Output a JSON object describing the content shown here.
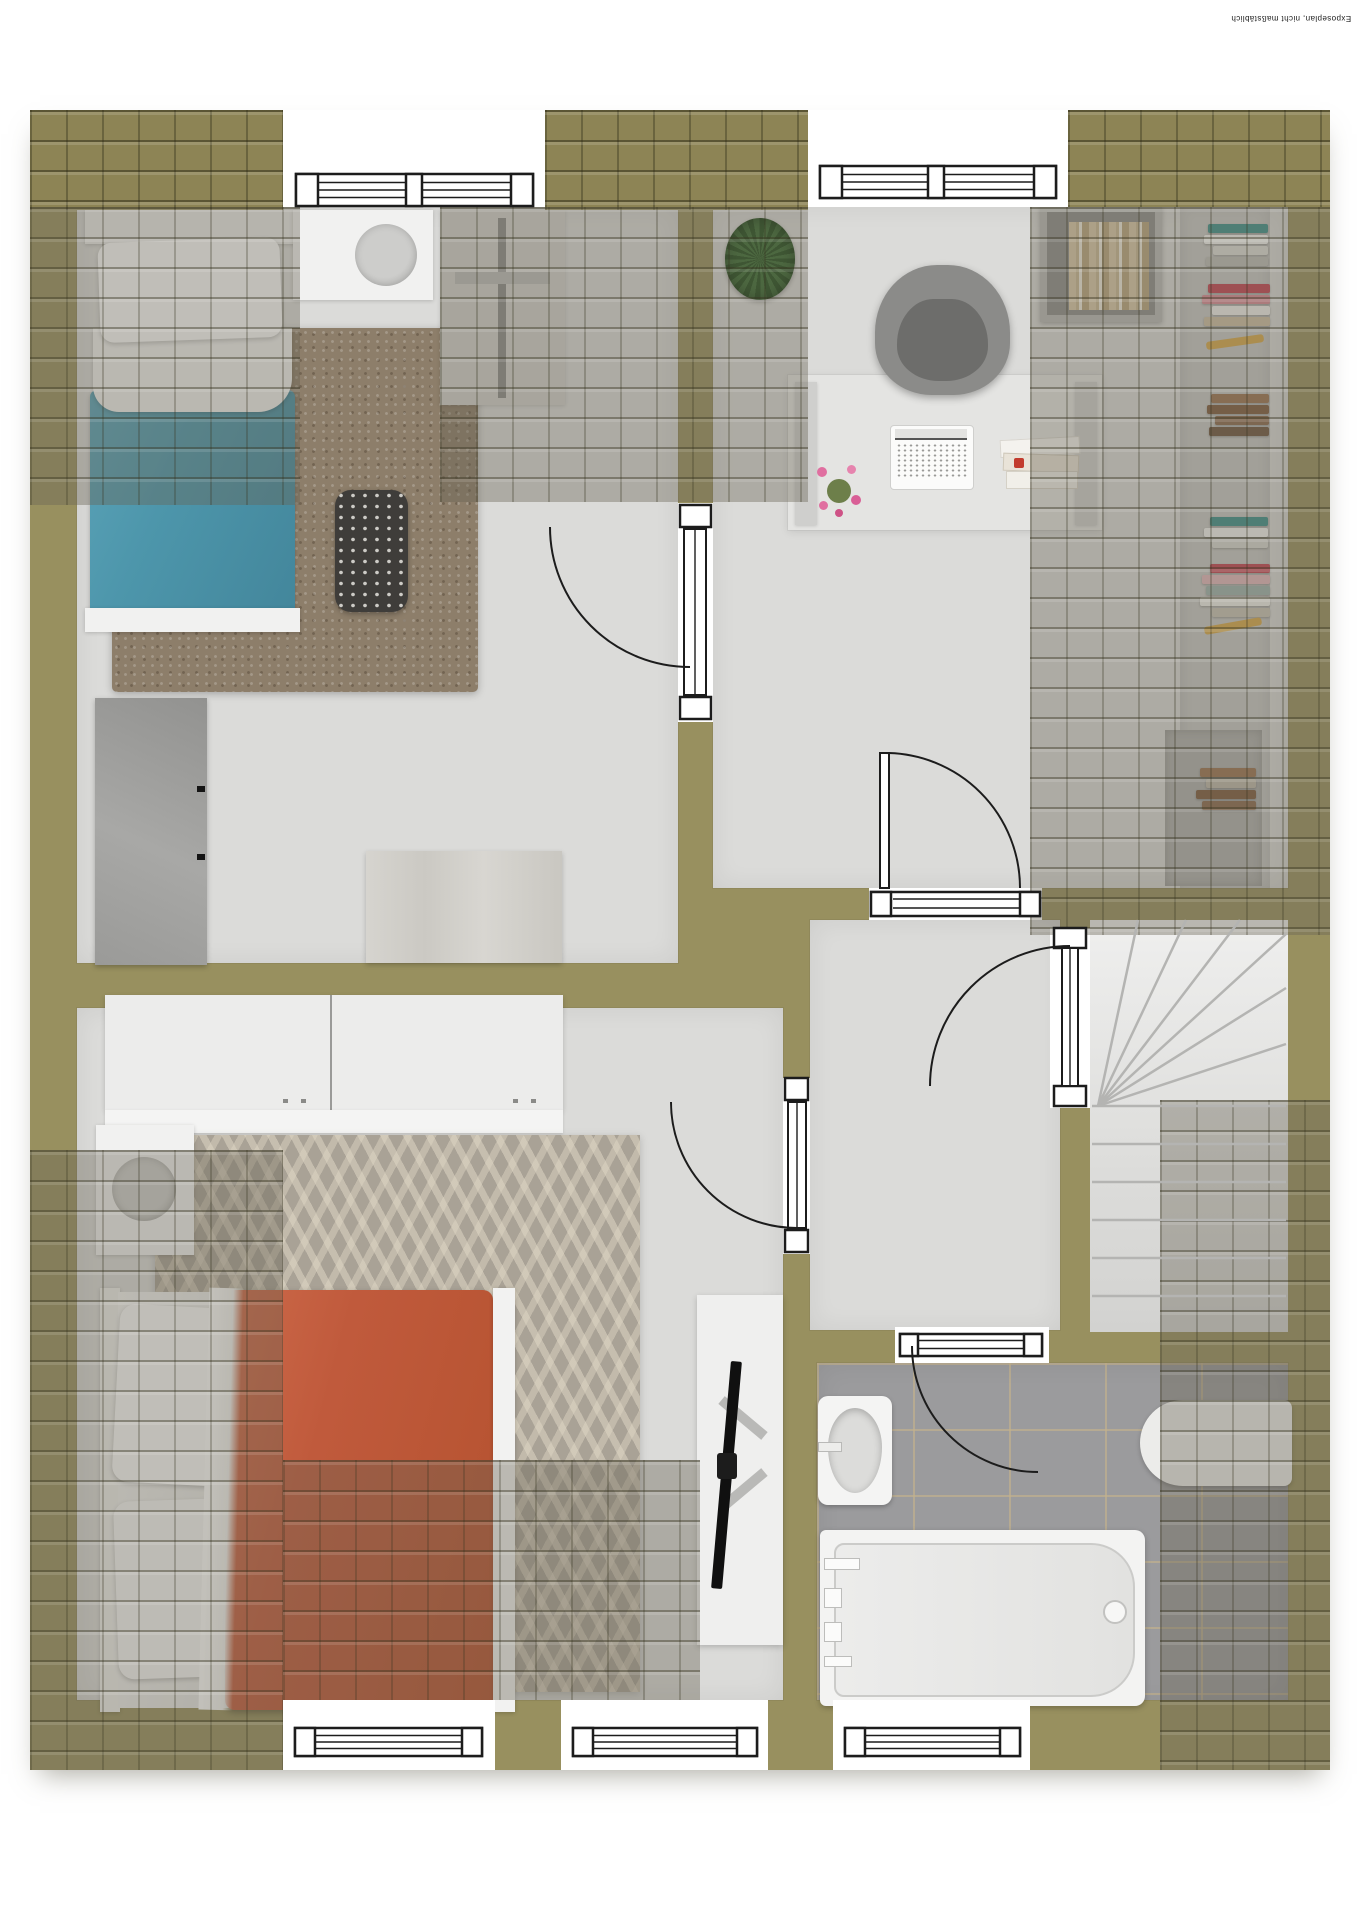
{
  "watermark": {
    "text": "Exposeplan, nicht maßstäblich"
  },
  "plan": {
    "type": "3d-floor-plan-top-view",
    "wall_color": "#98905f",
    "roof_tile_color": "#8d8455",
    "floor_color": "#dbdbd9",
    "bath_tile_color": "#9b9b9d",
    "openings": {
      "windows": 5,
      "doors": 5
    },
    "rooms": [
      {
        "id": "bedroom-1",
        "label": "Bedroom with single bed",
        "furniture": [
          "single-bed-blue-blanket",
          "nightstand-with-lamp",
          "brown-shag-rug",
          "dark-patterned-armchair",
          "clothes-rail",
          "gray-dresser",
          "wood-sideboard"
        ]
      },
      {
        "id": "office",
        "label": "Office / study",
        "furniture": [
          "potted-plant",
          "desk-with-trestles",
          "office-chair",
          "laptop",
          "book-stack",
          "flower-vase",
          "wall-shelf-with-books",
          "wall-mounted-book-shelves"
        ]
      },
      {
        "id": "hallway",
        "label": "Hallway landing",
        "furniture": [
          "wall-box-shelf-with-books"
        ]
      },
      {
        "id": "stairs",
        "label": "Winder staircase",
        "furniture": []
      },
      {
        "id": "bedroom-2",
        "label": "Bedroom with double bed",
        "furniture": [
          "double-bed-terracotta-blanket",
          "two-door-wardrobe",
          "nightstand-with-lamp",
          "chevron-rug",
          "tv-board-with-tv"
        ]
      },
      {
        "id": "bathroom",
        "label": "Bathroom",
        "furniture": [
          "washbasin",
          "bathtub-with-faucet",
          "second-bathtub-under-roof-slope",
          "gray-floor-tiles"
        ]
      }
    ],
    "accents": {
      "bed1_blanket": "#4d96ab",
      "bed2_blanket": "#c05a3c",
      "book_colors": [
        "#3f8f8a",
        "#c24452",
        "#8a6a4f",
        "#d7a94b"
      ]
    }
  }
}
